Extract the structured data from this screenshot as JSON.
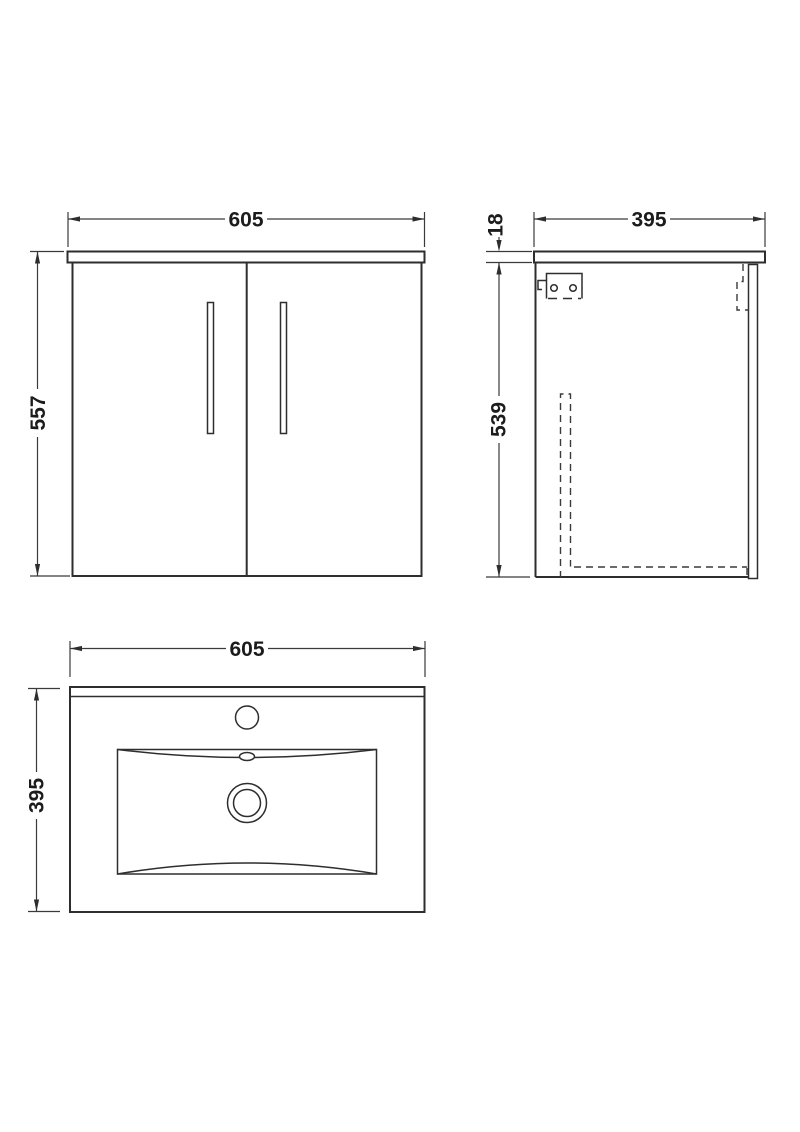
{
  "drawing": {
    "type": "technical-drawing",
    "subject": "wall-hung-vanity-unit-with-basin",
    "background_color": "#ffffff",
    "line_color": "#2e2e2e",
    "views": {
      "front": {
        "name": "front-elevation",
        "width_label": "605",
        "height_label": "557"
      },
      "side": {
        "name": "side-elevation",
        "depth_label": "395",
        "worktop_thickness_label": "18",
        "cabinet_height_label": "539"
      },
      "plan": {
        "name": "basin-plan",
        "width_label": "605",
        "depth_label": "395"
      }
    }
  }
}
